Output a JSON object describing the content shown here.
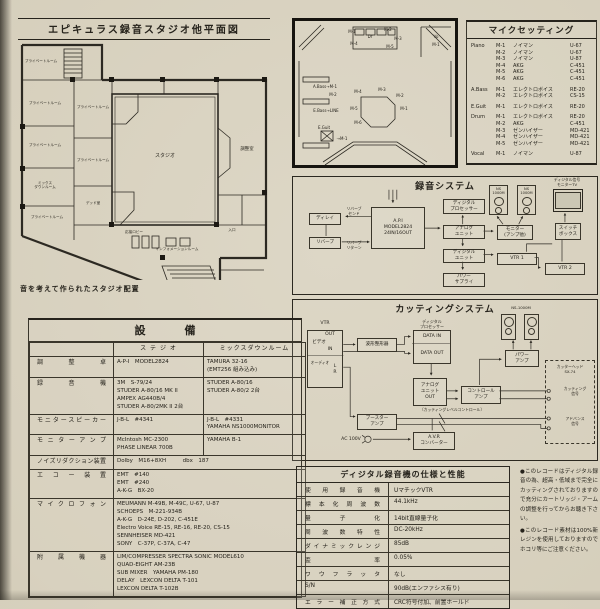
{
  "colors": {
    "paper": "#d6cfbc",
    "ink": "#26231c",
    "wall": "#2c2922"
  },
  "floorplan": {
    "title": "エピキュラス録音スタジオ他平面図",
    "caption": "音を考えて作られたスタジオ配置",
    "rooms": [
      {
        "label": "プライベートルーム",
        "x": 6,
        "y": 16,
        "w": 42,
        "h": 10,
        "type": "text"
      },
      {
        "label": "プライベートルーム",
        "x": 8,
        "y": 58,
        "w": 46,
        "h": 10,
        "type": "text"
      },
      {
        "label": "プライベートルーム",
        "x": 8,
        "y": 100,
        "w": 46,
        "h": 10,
        "type": "text"
      },
      {
        "label": "ミックス\nダウンルーム",
        "x": 8,
        "y": 138,
        "w": 46,
        "h": 14,
        "type": "text"
      },
      {
        "label": "プライベートルーム",
        "x": 10,
        "y": 172,
        "w": 46,
        "h": 10,
        "type": "text"
      },
      {
        "label": "プライベートルーム",
        "x": 60,
        "y": 62,
        "w": 38,
        "h": 10,
        "type": "text"
      },
      {
        "label": "プライベートルーム",
        "x": 60,
        "y": 115,
        "w": 38,
        "h": 10,
        "type": "text"
      },
      {
        "label": "デッド室",
        "x": 62,
        "y": 158,
        "w": 34,
        "h": 10,
        "type": "text"
      },
      {
        "label": "スタジオ",
        "x": 122,
        "y": 110,
        "w": 58,
        "h": 12,
        "type": "text",
        "fs": "5px"
      },
      {
        "label": "調整室",
        "x": 216,
        "y": 105,
        "w": 34,
        "h": 10,
        "type": "text",
        "fs": "4.4px"
      },
      {
        "label": "応接ロビー",
        "x": 100,
        "y": 188,
        "w": 40,
        "h": 9,
        "type": "text"
      },
      {
        "label": "インフォメーションルーム",
        "x": 128,
        "y": 205,
        "w": 70,
        "h": 9,
        "type": "text"
      },
      {
        "label": "入口",
        "x": 208,
        "y": 186,
        "w": 20,
        "h": 9,
        "type": "text"
      }
    ]
  },
  "mic_diagram": {
    "labels": [
      {
        "label": "Dr",
        "x": 68,
        "y": 12,
        "w": 14,
        "h": 7,
        "type": "text"
      },
      {
        "label": "M-1",
        "x": 50,
        "y": 7,
        "w": 14,
        "h": 6,
        "type": "text"
      },
      {
        "label": "M-2",
        "x": 86,
        "y": 5,
        "w": 14,
        "h": 6,
        "type": "text"
      },
      {
        "label": "M-3",
        "x": 96,
        "y": 14,
        "w": 14,
        "h": 6,
        "type": "text"
      },
      {
        "label": "M-4",
        "x": 52,
        "y": 19,
        "w": 14,
        "h": 6,
        "type": "text"
      },
      {
        "label": "M-5",
        "x": 88,
        "y": 22,
        "w": 14,
        "h": 6,
        "type": "text"
      },
      {
        "label": "Vo",
        "x": 134,
        "y": 12,
        "w": 14,
        "h": 6,
        "type": "text"
      },
      {
        "label": "M-1",
        "x": 134,
        "y": 20,
        "w": 14,
        "h": 6,
        "type": "text"
      },
      {
        "label": "A.Bass→M-1",
        "x": 10,
        "y": 62,
        "w": 40,
        "h": 6,
        "type": "text"
      },
      {
        "label": "M-2",
        "x": 30,
        "y": 70,
        "w": 16,
        "h": 6,
        "type": "text"
      },
      {
        "label": "E.Bass→LINE",
        "x": 10,
        "y": 86,
        "w": 42,
        "h": 6,
        "type": "text"
      },
      {
        "label": "E.Guit",
        "x": 18,
        "y": 103,
        "w": 22,
        "h": 6,
        "type": "text"
      },
      {
        "label": "→M-1",
        "x": 38,
        "y": 114,
        "w": 18,
        "h": 6,
        "type": "text"
      },
      {
        "label": "M-4",
        "x": 56,
        "y": 67,
        "w": 14,
        "h": 6,
        "type": "text"
      },
      {
        "label": "M-3",
        "x": 80,
        "y": 65,
        "w": 14,
        "h": 6,
        "type": "text"
      },
      {
        "label": "M-2",
        "x": 98,
        "y": 71,
        "w": 14,
        "h": 6,
        "type": "text"
      },
      {
        "label": "M-1",
        "x": 102,
        "y": 84,
        "w": 14,
        "h": 6,
        "type": "text"
      },
      {
        "label": "M-5",
        "x": 52,
        "y": 84,
        "w": 14,
        "h": 6,
        "type": "text"
      },
      {
        "label": "M-6",
        "x": 56,
        "y": 98,
        "w": 14,
        "h": 6,
        "type": "text"
      }
    ]
  },
  "mic_setting": {
    "title": "マイクセッティング",
    "groups": [
      {
        "instrument": "Piano",
        "mics": [
          {
            "no": "M-1",
            "maker": "ノイマン",
            "model": "U-67"
          },
          {
            "no": "M-2",
            "maker": "ノイマン",
            "model": "U-67"
          },
          {
            "no": "M-3",
            "maker": "ノイマン",
            "model": "U-87"
          },
          {
            "no": "M-4",
            "maker": "AKG",
            "model": "C-451"
          },
          {
            "no": "M-5",
            "maker": "AKG",
            "model": "C-451"
          },
          {
            "no": "M-6",
            "maker": "AKG",
            "model": "C-451"
          }
        ]
      },
      {
        "instrument": "A.Bass",
        "mics": [
          {
            "no": "M-1",
            "maker": "エレクトロボイス",
            "model": "RE-20"
          },
          {
            "no": "M-2",
            "maker": "エレクトロボイス",
            "model": "CS-15"
          }
        ]
      },
      {
        "instrument": "E.Guit",
        "mics": [
          {
            "no": "M-1",
            "maker": "エレクトロボイス",
            "model": "RE-20"
          }
        ]
      },
      {
        "instrument": "Drum",
        "mics": [
          {
            "no": "M-1",
            "maker": "エレクトロボイス",
            "model": "RE-20"
          },
          {
            "no": "M-2",
            "maker": "AKG",
            "model": "C-451"
          },
          {
            "no": "M-3",
            "maker": "ゼンハイザー",
            "model": "MD-421"
          },
          {
            "no": "M-4",
            "maker": "ゼンハイザー",
            "model": "MD-421"
          },
          {
            "no": "M-5",
            "maker": "ゼンハイザー",
            "model": "MD-421"
          }
        ]
      },
      {
        "instrument": "Vocal",
        "mics": [
          {
            "no": "M-1",
            "maker": "ノイマン",
            "model": "U-87"
          }
        ]
      }
    ]
  },
  "recording_system": {
    "title": "録音システム",
    "nodes": [
      {
        "label": "ディレイ",
        "x": 16,
        "y": 36,
        "w": 32,
        "h": 12
      },
      {
        "label": "リバーブ",
        "x": 16,
        "y": 60,
        "w": 32,
        "h": 12
      },
      {
        "label": "リバーブ\nセンド",
        "x": 48,
        "y": 30,
        "w": 26,
        "h": 10,
        "type": "text",
        "fs": "3.8px"
      },
      {
        "label": "リバーブ\nリターン",
        "x": 48,
        "y": 64,
        "w": 26,
        "h": 10,
        "type": "text",
        "fs": "3.8px"
      },
      {
        "label": "A.P.I\nMODEL2824\n24IN/16OUT",
        "x": 78,
        "y": 30,
        "w": 54,
        "h": 42
      },
      {
        "label": "ディジタル\nプロセッサー",
        "x": 150,
        "y": 22,
        "w": 42,
        "h": 15
      },
      {
        "label": "アナログ\nユニット",
        "x": 150,
        "y": 48,
        "w": 42,
        "h": 14
      },
      {
        "label": "ディジタル\nユニット",
        "x": 150,
        "y": 72,
        "w": 42,
        "h": 14
      },
      {
        "label": "パワー\nサプライ",
        "x": 150,
        "y": 96,
        "w": 42,
        "h": 14
      },
      {
        "label": "モニター\n(アンプ他)",
        "x": 204,
        "y": 48,
        "w": 36,
        "h": 15
      },
      {
        "label": "NS\n1000M",
        "x": 196,
        "y": 8,
        "w": 19,
        "h": 30,
        "type": "speaker"
      },
      {
        "label": "NS\n1000M",
        "x": 224,
        "y": 8,
        "w": 19,
        "h": 30,
        "type": "speaker"
      },
      {
        "label": "VTR 1",
        "x": 204,
        "y": 76,
        "w": 40,
        "h": 12
      },
      {
        "label": "VTR 2",
        "x": 252,
        "y": 86,
        "w": 40,
        "h": 12
      },
      {
        "label": "スイッチ\nボックス",
        "x": 262,
        "y": 46,
        "w": 26,
        "h": 17
      },
      {
        "label": "",
        "x": 260,
        "y": 12,
        "w": 30,
        "h": 23,
        "type": "tv"
      },
      {
        "label": "ディジタル信号\nモニターTV",
        "x": 250,
        "y": 0,
        "w": 48,
        "h": 11,
        "type": "text",
        "fs": "3.8px"
      }
    ]
  },
  "cutting_system": {
    "title": "カッティングシステム",
    "nodes": [
      {
        "label": "VTR",
        "x": 14,
        "y": 20,
        "w": 36,
        "h": 8,
        "type": "text"
      },
      {
        "label": "",
        "x": 14,
        "y": 30,
        "w": 36,
        "h": 58
      },
      {
        "label": "OUT",
        "x": 28,
        "y": 32,
        "w": 18,
        "h": 6,
        "type": "text"
      },
      {
        "label": "ビデオ",
        "x": 15,
        "y": 40,
        "w": 22,
        "h": 6,
        "type": "text"
      },
      {
        "label": "IN",
        "x": 30,
        "y": 47,
        "w": 14,
        "h": 6,
        "type": "text"
      },
      {
        "label": "オーディオ",
        "x": 14,
        "y": 60,
        "w": 26,
        "h": 6,
        "type": "text",
        "fs": "3.8px"
      },
      {
        "label": "L",
        "x": 38,
        "y": 64,
        "w": 8,
        "h": 6,
        "type": "text"
      },
      {
        "label": "R",
        "x": 38,
        "y": 70,
        "w": 8,
        "h": 6,
        "type": "text"
      },
      {
        "label": "波形整形器",
        "x": 64,
        "y": 38,
        "w": 40,
        "h": 14
      },
      {
        "label": "ディジタル\nプロセッサー",
        "x": 116,
        "y": 18,
        "w": 46,
        "h": 11,
        "type": "text",
        "fs": "4px"
      },
      {
        "label": "",
        "x": 120,
        "y": 30,
        "w": 38,
        "h": 34
      },
      {
        "label": "DATA IN",
        "x": 121,
        "y": 33,
        "w": 36,
        "h": 7,
        "type": "text"
      },
      {
        "label": "DATA OUT",
        "x": 121,
        "y": 50,
        "w": 36,
        "h": 7,
        "type": "text"
      },
      {
        "label": "アナログ\nユニット\nOUT",
        "x": 120,
        "y": 78,
        "w": 34,
        "h": 28
      },
      {
        "label": "コントロール\nアンプ",
        "x": 168,
        "y": 86,
        "w": 40,
        "h": 18
      },
      {
        "label": "パワー\nアンプ",
        "x": 212,
        "y": 50,
        "w": 34,
        "h": 17
      },
      {
        "label": "NS-1000M",
        "x": 204,
        "y": 4,
        "w": 48,
        "h": 8,
        "type": "text",
        "fs": "3.8px"
      },
      {
        "label": "",
        "x": 208,
        "y": 14,
        "w": 15,
        "h": 26,
        "type": "speaker"
      },
      {
        "label": "",
        "x": 231,
        "y": 14,
        "w": 15,
        "h": 26,
        "type": "speaker"
      },
      {
        "label": "ブースター\nアンプ",
        "x": 64,
        "y": 114,
        "w": 40,
        "h": 16
      },
      {
        "label": "A.V.R\nコンバーター",
        "x": 120,
        "y": 132,
        "w": 42,
        "h": 18
      },
      {
        "label": "AC 100V",
        "x": 44,
        "y": 136,
        "w": 28,
        "h": 8,
        "type": "text"
      },
      {
        "label": "〔カッティングレベルコントロール〕",
        "x": 100,
        "y": 106,
        "w": 118,
        "h": 8,
        "type": "text",
        "fs": "3.8px"
      },
      {
        "label": "",
        "x": 252,
        "y": 60,
        "w": 50,
        "h": 84,
        "type": "dashed"
      },
      {
        "label": "カッターヘッド\nSX-74",
        "x": 254,
        "y": 63,
        "w": 46,
        "h": 13,
        "type": "text",
        "fs": "3.8px"
      },
      {
        "label": "カッティング\n信号",
        "x": 264,
        "y": 86,
        "w": 36,
        "h": 12,
        "type": "text",
        "fs": "3.8px"
      },
      {
        "label": "アドバンス\n信号",
        "x": 264,
        "y": 116,
        "w": 36,
        "h": 12,
        "type": "text",
        "fs": "3.8px"
      }
    ]
  },
  "equipment": {
    "title": "設　備",
    "col_studio": "ス テ ジ オ",
    "col_mixdown": "ミックスダウンルーム",
    "rows": [
      {
        "label": "調整卓",
        "studio": [
          "A-P-I　MODEL2824"
        ],
        "mixdown": [
          "TAMURA 32-16",
          "(EMT256 組み込み)"
        ]
      },
      {
        "label": "録音機",
        "studio": [
          "3M　S-79/24",
          "STUDER A-80/16 MK II",
          "AMPEX AG440B/4",
          "STUDER A-80/2MK II 2台"
        ],
        "mixdown": [
          "STUDER A-80/16",
          "STUDER A-80/2 2台"
        ]
      },
      {
        "label": "モニタースピーカー",
        "studio": [
          "J-B-L　#4341"
        ],
        "mixdown": [
          "J-B-L　#4331",
          "YAMAHA NS1000MONITOR"
        ]
      },
      {
        "label": "モニターアンプ",
        "studio": [
          "McIntosh MC-2300",
          "PHASE LINEAR 700B"
        ],
        "mixdown": [
          "YAMAHA B-1"
        ]
      },
      {
        "label": "ノイズリダクション装置",
        "span": [
          "Dolby　M16+8XH　　　dbx　187"
        ]
      },
      {
        "label": "エコー装置",
        "span": [
          "EMT　#140",
          "EMT　#240",
          "A-K-G　BX-20"
        ]
      },
      {
        "label": "マイクロフォン",
        "span": [
          "MEUMANN M-49B, M-49C, U-67, U-87",
          "SCHOEPS　M-221-934B",
          "A-K-G　D-24E, D-202, C-451E",
          "Electro Voice RE-15, RE-16, RE-20, CS-15",
          "SENNHEISER MD-421",
          "SONY　C-37P, C-37A, C-47"
        ]
      },
      {
        "label": "附属機器",
        "span": [
          "LIM/COMPRESSER SPECTRA SONIC MODEL610",
          "QUAD-EIGHT AM-23B",
          "SUB MIXER　YAMAHA PM-180",
          "DELAY　LEXCON DELTA T-101",
          "LEXCON DELTA T-102B"
        ]
      }
    ]
  },
  "digital_spec": {
    "title": "ディジタル録音機の仕様と性能",
    "rows": [
      [
        "使用録音機",
        "UマチックVTR"
      ],
      [
        "標本化周波数",
        "44.1kHz"
      ],
      [
        "量子化",
        "14bit直線量子化"
      ],
      [
        "周波数特性",
        "DC-20kHz"
      ],
      [
        "ダイナミックレンジ",
        "85dB"
      ],
      [
        "歪率",
        "0.05%"
      ],
      [
        "ワウフラッタ",
        "なし"
      ],
      [
        "S/N",
        "90dB(エンファシス有り)"
      ],
      [
        "エラー補正方式",
        "CRC符号付加、前置ホールド"
      ]
    ]
  },
  "notes": {
    "items": [
      "●このレコードはディジタル録音の為、超高・低域まで完全にカッティングされておりますので充分にカートリッジ・アームの調整を行ってからお聴き下さい。",
      "●このレコード素材は100%新レジンを使用しておりますのでホコリ等にご注意ください。"
    ]
  }
}
